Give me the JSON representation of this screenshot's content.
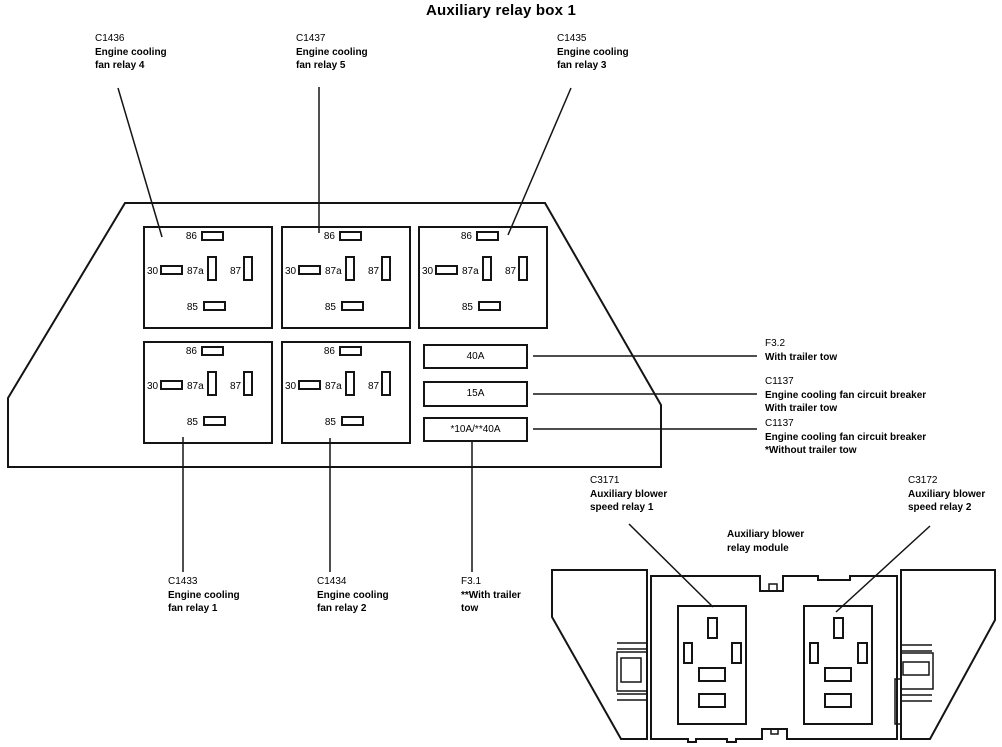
{
  "title": "Auxiliary relay box 1",
  "colors": {
    "line": "#141414",
    "text": "#000000",
    "background": "#ffffff"
  },
  "pins": {
    "p86": "86",
    "p30": "30",
    "p87a": "87a",
    "p87": "87",
    "p85": "85"
  },
  "fuses": {
    "f1": "40A",
    "f2": "15A",
    "f3": "*10A/**40A"
  },
  "labels": {
    "c1436": {
      "id": "C1436",
      "line1": "Engine cooling",
      "line2": "fan relay 4"
    },
    "c1437": {
      "id": "C1437",
      "line1": "Engine cooling",
      "line2": "fan relay 5"
    },
    "c1435": {
      "id": "C1435",
      "line1": "Engine cooling",
      "line2": "fan relay 3"
    },
    "c1433": {
      "id": "C1433",
      "line1": "Engine cooling",
      "line2": "fan relay 1"
    },
    "c1434": {
      "id": "C1434",
      "line1": "Engine cooling",
      "line2": "fan relay 2"
    },
    "f3_1": {
      "id": "F3.1",
      "line1": "**With trailer",
      "line2": "tow"
    },
    "f3_2": {
      "id": "F3.2",
      "line1": "With trailer tow"
    },
    "c1137_with": {
      "id": "C1137",
      "line1": "Engine cooling fan circuit breaker",
      "line2": "With trailer tow"
    },
    "c1137_without": {
      "id": "C1137",
      "line1": "Engine cooling fan circuit breaker",
      "line2": "*Without trailer tow"
    },
    "c3171": {
      "id": "C3171",
      "line1": "Auxiliary blower",
      "line2": "speed relay 1"
    },
    "c3172": {
      "id": "C3172",
      "line1": "Auxiliary blower",
      "line2": "speed relay 2"
    },
    "module": {
      "line1": "Auxiliary blower",
      "line2": "relay module"
    }
  }
}
